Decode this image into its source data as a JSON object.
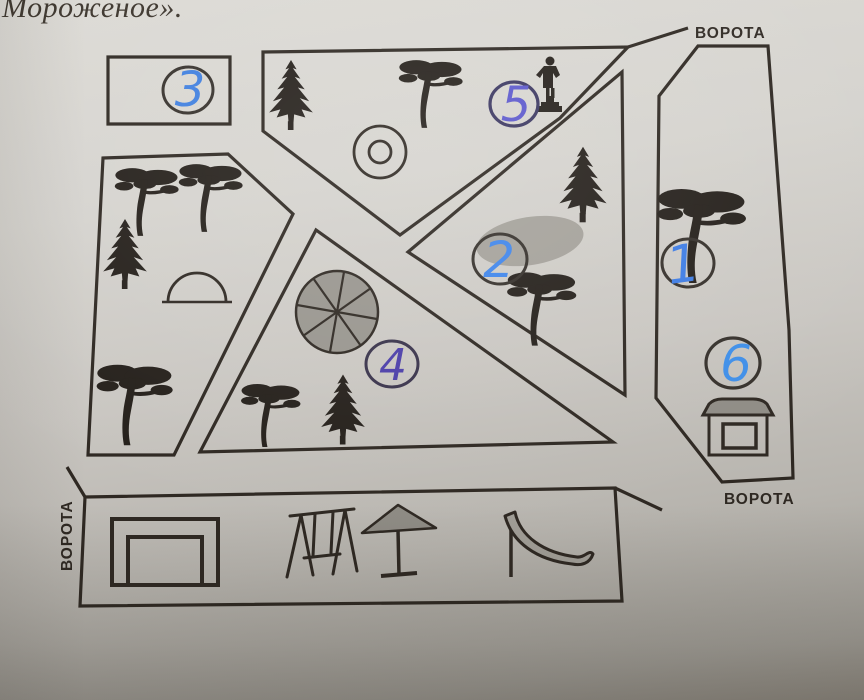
{
  "page": {
    "heading_fragment": "Мороженое»."
  },
  "map": {
    "gates": [
      {
        "position": "top-right",
        "label": "ВОРОТА"
      },
      {
        "position": "bottom-right",
        "label": "ВОРОТА"
      },
      {
        "position": "left",
        "label": "ВОРОТА"
      }
    ],
    "areas": [
      {
        "number": "1",
        "features": [
          "deciduous-tree"
        ]
      },
      {
        "number": "2",
        "features": [
          "pond",
          "fir-tree",
          "deciduous-tree"
        ]
      },
      {
        "number": "3",
        "features": []
      },
      {
        "number": "4",
        "features": [
          "round-flowerbed",
          "deciduous-tree",
          "fir-tree"
        ]
      },
      {
        "number": "5",
        "features": [
          "fir-tree",
          "deciduous-tree",
          "fountain",
          "statue"
        ]
      },
      {
        "number": "6",
        "features": [
          "kiosk"
        ]
      }
    ],
    "left_grove_features": [
      "deciduous-tree",
      "deciduous-tree",
      "fir-tree",
      "dome-arc",
      "deciduous-tree"
    ],
    "playground_features": [
      "sandbox",
      "swing-set",
      "umbrella",
      "slide"
    ],
    "colors": {
      "line": "#2e2822",
      "tree": "#241f1a",
      "gray_fill": "#98958e",
      "pen_blue": "#3f80e6",
      "pen_violet": "#4a3da8",
      "paper_light": "#d9d7d2",
      "paper_dark": "#9c9992"
    }
  }
}
